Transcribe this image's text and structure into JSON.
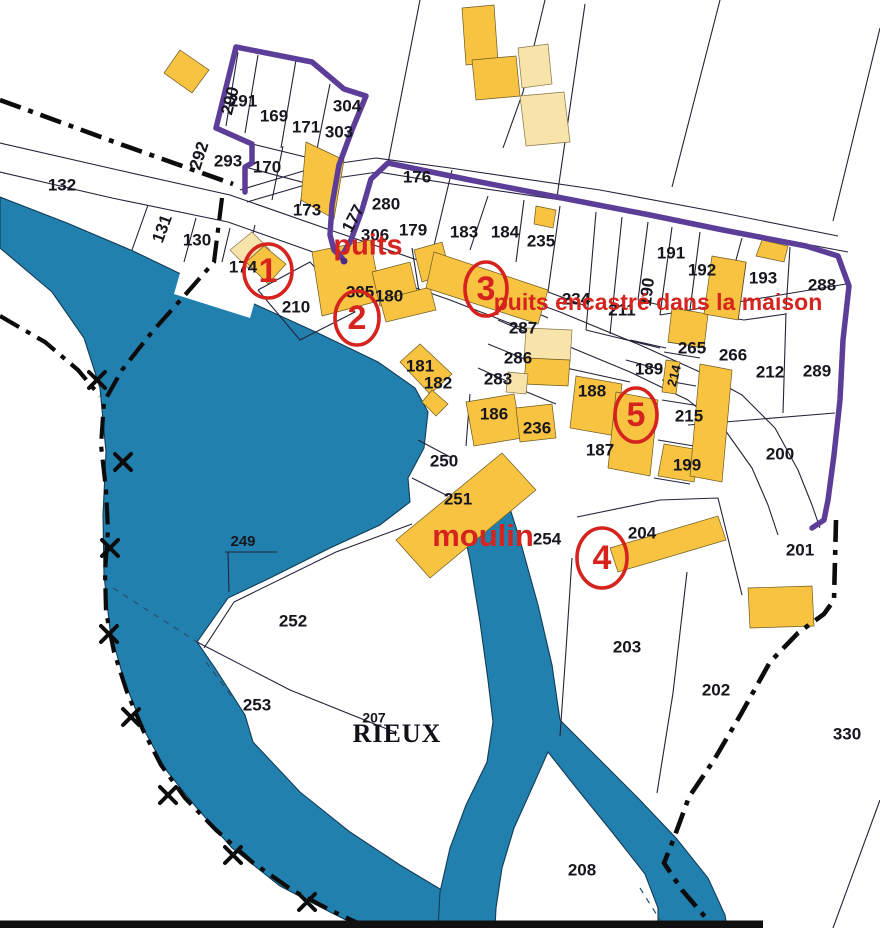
{
  "map": {
    "region_name": "RIEUX",
    "colors": {
      "water": "#2280AE",
      "building": "#F7C340",
      "building_pale": "#F8E3AB",
      "boundary_purple": "#5C3E99",
      "annotation_red": "#D6231E"
    },
    "parcel_labels": [
      {
        "t": "132",
        "x": 62,
        "y": 186
      },
      {
        "t": "131",
        "x": 163,
        "y": 229,
        "r": -70
      },
      {
        "t": "130",
        "x": 197,
        "y": 241
      },
      {
        "t": "174",
        "x": 243,
        "y": 268
      },
      {
        "t": "290",
        "x": 231,
        "y": 101,
        "r": -75
      },
      {
        "t": "291",
        "x": 243,
        "y": 102
      },
      {
        "t": "169",
        "x": 274,
        "y": 117
      },
      {
        "t": "171",
        "x": 306,
        "y": 128
      },
      {
        "t": "304",
        "x": 347,
        "y": 107
      },
      {
        "t": "303",
        "x": 339,
        "y": 133
      },
      {
        "t": "292",
        "x": 200,
        "y": 156,
        "r": -72
      },
      {
        "t": "293",
        "x": 228,
        "y": 162
      },
      {
        "t": "170",
        "x": 267,
        "y": 168
      },
      {
        "t": "173",
        "x": 307,
        "y": 211
      },
      {
        "t": "177",
        "x": 354,
        "y": 219,
        "r": -62
      },
      {
        "t": "280",
        "x": 386,
        "y": 205
      },
      {
        "t": "306",
        "x": 375,
        "y": 236
      },
      {
        "t": "179",
        "x": 413,
        "y": 231
      },
      {
        "t": "176",
        "x": 417,
        "y": 178
      },
      {
        "t": "183",
        "x": 464,
        "y": 233
      },
      {
        "t": "184",
        "x": 505,
        "y": 233
      },
      {
        "t": "235",
        "x": 541,
        "y": 242
      },
      {
        "t": "234",
        "x": 576,
        "y": 300
      },
      {
        "t": "211",
        "x": 622,
        "y": 311
      },
      {
        "t": "190",
        "x": 648,
        "y": 292,
        "r": -83
      },
      {
        "t": "191",
        "x": 671,
        "y": 254
      },
      {
        "t": "192",
        "x": 702,
        "y": 271
      },
      {
        "t": "193",
        "x": 763,
        "y": 279
      },
      {
        "t": "288",
        "x": 822,
        "y": 286
      },
      {
        "t": "305",
        "x": 360,
        "y": 293
      },
      {
        "t": "180",
        "x": 389,
        "y": 297
      },
      {
        "t": "210",
        "x": 296,
        "y": 308
      },
      {
        "t": "287",
        "x": 523,
        "y": 329
      },
      {
        "t": "286",
        "x": 518,
        "y": 359
      },
      {
        "t": "283",
        "x": 498,
        "y": 380
      },
      {
        "t": "181",
        "x": 420,
        "y": 367
      },
      {
        "t": "182",
        "x": 438,
        "y": 384
      },
      {
        "t": "186",
        "x": 494,
        "y": 415
      },
      {
        "t": "236",
        "x": 537,
        "y": 429
      },
      {
        "t": "188",
        "x": 592,
        "y": 392
      },
      {
        "t": "189",
        "x": 649,
        "y": 370
      },
      {
        "t": "214",
        "x": 675,
        "y": 376,
        "r": -75,
        "s": 13
      },
      {
        "t": "265",
        "x": 692,
        "y": 349
      },
      {
        "t": "266",
        "x": 733,
        "y": 356
      },
      {
        "t": "212",
        "x": 770,
        "y": 373
      },
      {
        "t": "289",
        "x": 817,
        "y": 372
      },
      {
        "t": "215",
        "x": 689,
        "y": 417
      },
      {
        "t": "199",
        "x": 687,
        "y": 466
      },
      {
        "t": "200",
        "x": 780,
        "y": 455
      },
      {
        "t": "187",
        "x": 600,
        "y": 451
      },
      {
        "t": "250",
        "x": 444,
        "y": 462
      },
      {
        "t": "251",
        "x": 458,
        "y": 500
      },
      {
        "t": "254",
        "x": 547,
        "y": 540
      },
      {
        "t": "204",
        "x": 642,
        "y": 534
      },
      {
        "t": "201",
        "x": 800,
        "y": 551
      },
      {
        "t": "249",
        "x": 243,
        "y": 542,
        "s": 15
      },
      {
        "t": "252",
        "x": 293,
        "y": 622
      },
      {
        "t": "253",
        "x": 257,
        "y": 706
      },
      {
        "t": "203",
        "x": 627,
        "y": 648
      },
      {
        "t": "202",
        "x": 716,
        "y": 691
      },
      {
        "t": "330",
        "x": 847,
        "y": 735
      },
      {
        "t": "208",
        "x": 582,
        "y": 871
      },
      {
        "t": "207",
        "x": 374,
        "y": 719,
        "s": 14
      }
    ],
    "place_label": {
      "number": "207",
      "name": "RIEUX",
      "x": 397,
      "y": 742,
      "size": 26
    },
    "annotations": [
      {
        "id": "puits",
        "text": "puits",
        "x": 368,
        "y": 247,
        "size": 29
      },
      {
        "id": "puits-encastre",
        "text": "puits encastré dans la maison",
        "x": 658,
        "y": 304,
        "size": 23
      },
      {
        "id": "moulin",
        "text": "moulin",
        "x": 483,
        "y": 538,
        "size": 31
      }
    ],
    "markers": [
      {
        "n": "1",
        "x": 268,
        "y": 271,
        "rx": 24,
        "ry": 27
      },
      {
        "n": "2",
        "x": 357,
        "y": 318,
        "rx": 22,
        "ry": 27
      },
      {
        "n": "3",
        "x": 486,
        "y": 289,
        "rx": 21,
        "ry": 27
      },
      {
        "n": "4",
        "x": 602,
        "y": 558,
        "rx": 25,
        "ry": 30
      },
      {
        "n": "5",
        "x": 636,
        "y": 415,
        "rx": 21,
        "ry": 27
      }
    ]
  }
}
